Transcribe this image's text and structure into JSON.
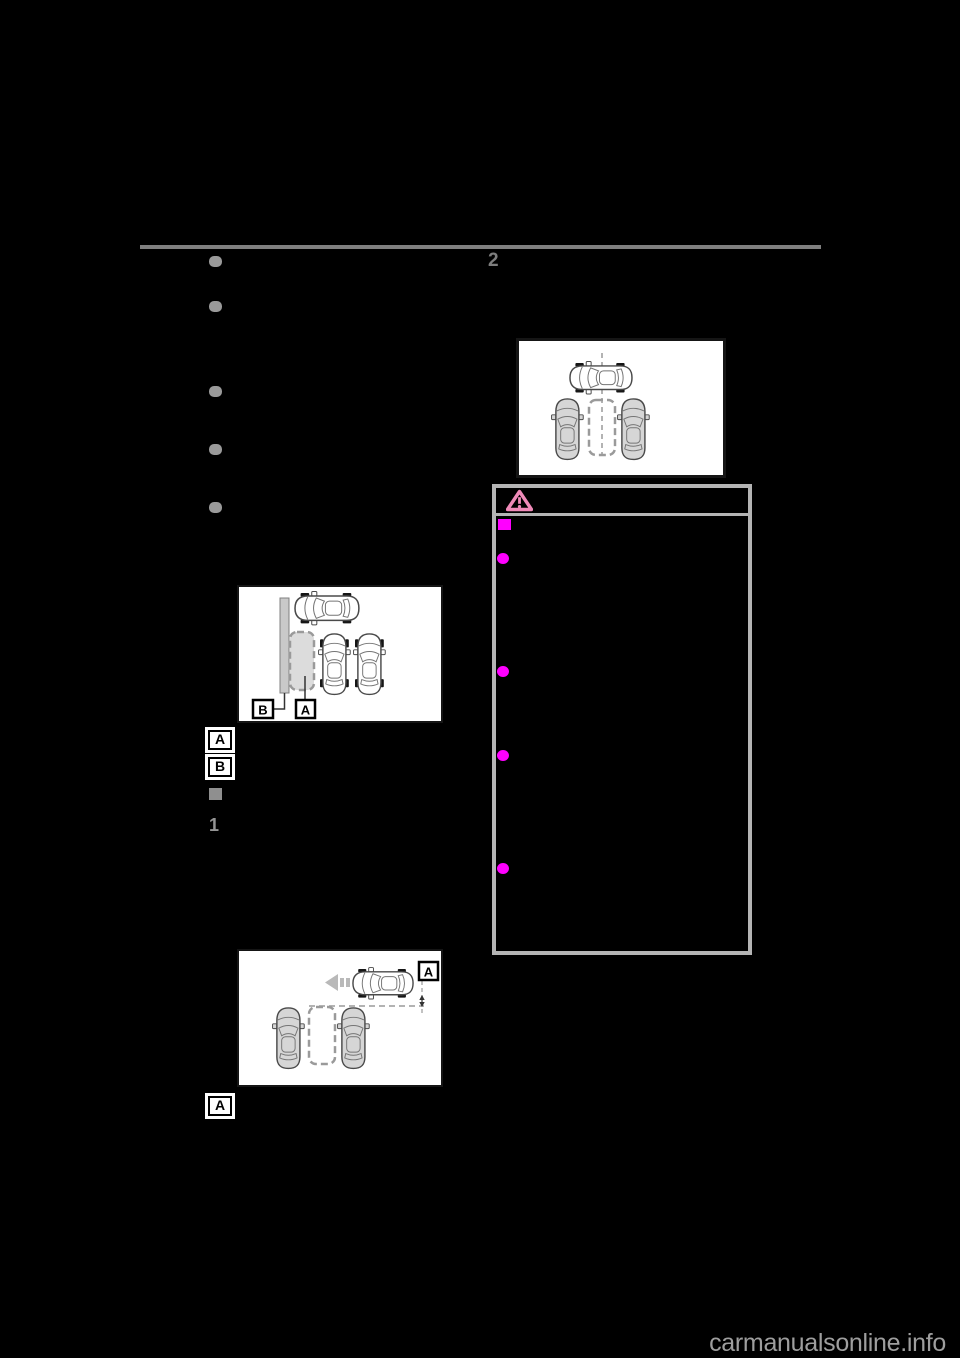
{
  "page": {
    "background": "#000000"
  },
  "markers": {
    "right_step_number": "2",
    "left_step_number": "1",
    "margin_label_1": "A",
    "margin_label_2": "B",
    "margin_label_3": "A"
  },
  "figure1": {
    "name": "parking-space-beside-wall-diagram",
    "label_a": "A",
    "label_b": "B"
  },
  "figure2": {
    "name": "vehicle-centered-over-parking-space-diagram"
  },
  "figure3": {
    "name": "vehicle-passing-parking-space-diagram",
    "label_a": "A"
  },
  "caution": {
    "icon": "warning-triangle-icon",
    "section_square_bullets": 1,
    "circle_bullets": 4
  },
  "left_column_bullets": 5,
  "colors": {
    "divider_gray": "#7f7f7f",
    "list_bullet_gray": "#9a9a9a",
    "caution_bullet_magenta": "#ff00ff",
    "caution_triangle_pink": "#ef8ab8",
    "caution_border_gray": "#b4b4b4",
    "watermark_gray": "#9e9e9e"
  },
  "watermark": {
    "text": "carmanualsonline.info"
  }
}
